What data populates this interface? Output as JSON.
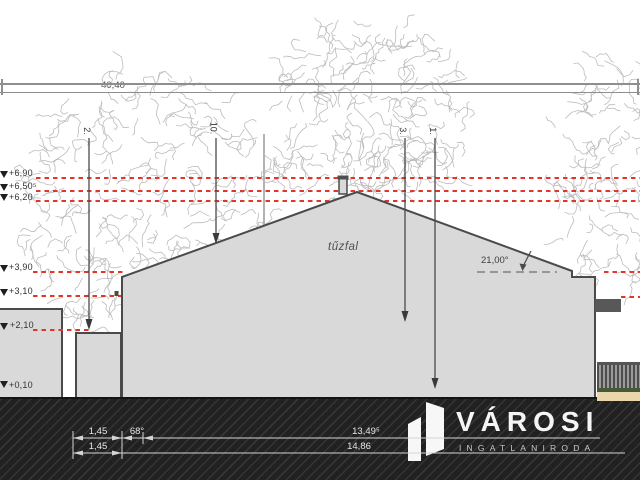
{
  "dimensions": {
    "overall_width": "40,40",
    "roof_angle": "21,00°",
    "bottom_row1": {
      "d1": "1,45",
      "angle": "68°",
      "d2": "13,49⁵"
    },
    "bottom_row2": {
      "d1": "1,45",
      "d2": "14,86"
    }
  },
  "elevations": [
    {
      "label": "+6,90"
    },
    {
      "label": "+6,50⁵"
    },
    {
      "label": "+6,20"
    },
    {
      "label": "+3,90"
    },
    {
      "label": "+3,10"
    },
    {
      "label": "+2,10"
    },
    {
      "label": "+0,10"
    }
  ],
  "section_marks": [
    {
      "label": "2."
    },
    {
      "label": "10."
    },
    {
      "label": "3."
    },
    {
      "label": "1."
    }
  ],
  "labels": {
    "firewall": "tűzfal"
  },
  "watermark": {
    "name": "VÁROSI",
    "subtitle": "INGATLANIRODA"
  },
  "colors": {
    "red_dashed": "#e2352b",
    "building_fill": "#d9d9d9",
    "outline": "#4a4a4a",
    "ground": "#212121",
    "watermark_text": "#f5f5f5"
  }
}
